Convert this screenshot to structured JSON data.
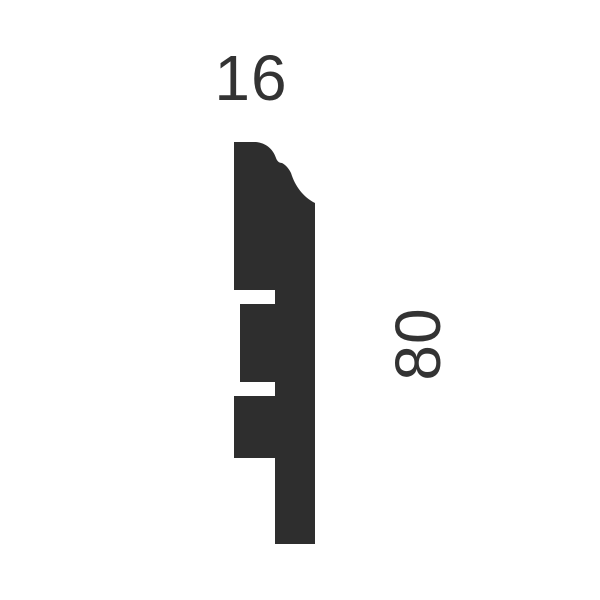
{
  "diagram": {
    "background_color": "#ffffff",
    "text_color": "#333333",
    "profile": {
      "description": "skirting-board-cross-section-silhouette",
      "fill_color": "#2e2e2e",
      "path": "M 234 142 L 256 142 C 266 143 273 149 276 158 C 277 161 279 163 282 163 C 286 165 289 169 291 173 C 295 186 303 197 315 203 L 315 544 L 275 544 L 275 458 L 234 458 L 234 396 L 275 396 L 275 382 L 240 382 L 240 304 L 275 304 L 275 290 L 234 290 Z"
    },
    "dimensions": {
      "width": {
        "label": "16"
      },
      "height": {
        "label": "80"
      }
    }
  }
}
